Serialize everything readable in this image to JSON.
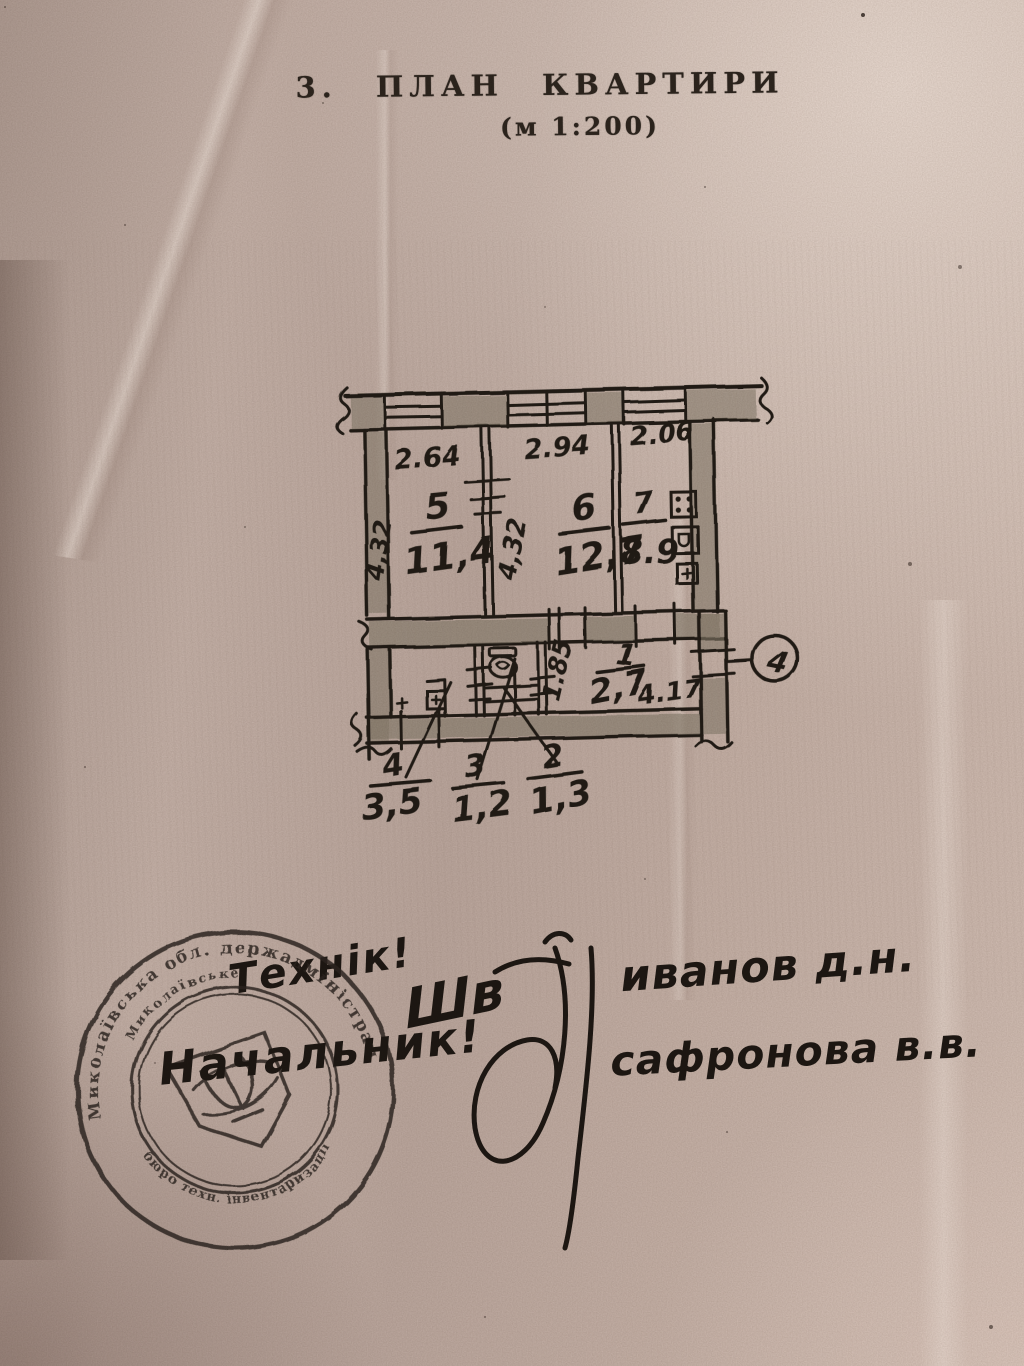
{
  "document": {
    "title": "3. ПЛАН КВАРТИРИ",
    "scale_note": "(м 1:200)"
  },
  "floor_plan": {
    "axis_marker": "4",
    "rooms": {
      "r5": {
        "num": "5",
        "area": "11,4",
        "width": "2.64",
        "height": "4,32"
      },
      "r6": {
        "num": "6",
        "area": "12,7",
        "width": "2.94",
        "height": "4,32"
      },
      "r7": {
        "num": "7",
        "area": "8.9",
        "width": "2.06"
      },
      "r1": {
        "num": "1",
        "area": "2,7",
        "width": "1.85",
        "length": "4.17"
      },
      "r2": {
        "num": "2",
        "area": "1,3"
      },
      "r3": {
        "num": "3",
        "area": "1,2"
      },
      "r4": {
        "num": "4",
        "area": "3,5"
      }
    }
  },
  "handwriting": {
    "technician": "Технік!",
    "chief": "Начальник!",
    "initials": "Шв",
    "name_1": "иванов д.н.",
    "name_2": "сафронова в.в."
  },
  "stamp": {
    "ring_outer": "Миколаївська обл. держадміністрація",
    "ring_inner_top": "Миколаївське",
    "ring_inner_bottom": "бюро техн. інвентаризації",
    "emblem": "trident"
  },
  "colors": {
    "paper": "#c8b4ab",
    "ink": "#241e18",
    "stamp_ink": "#2f2822",
    "wall_shade": "#8b8070"
  }
}
